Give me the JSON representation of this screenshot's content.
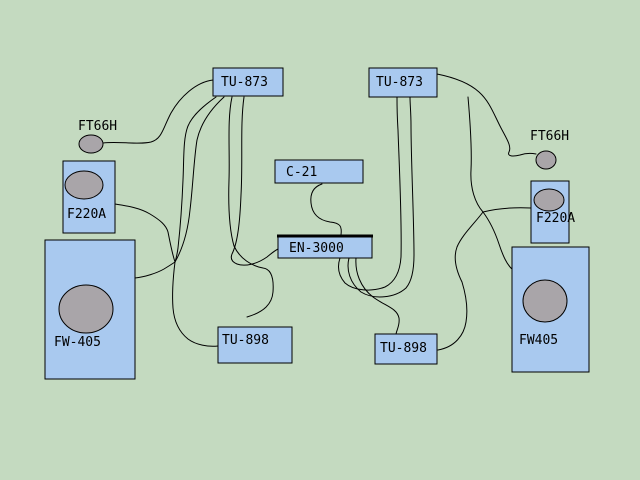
{
  "diagram": {
    "title": "stereo-system-wiring-diagram",
    "colors": {
      "background": "#c4dac0",
      "component_box_fill": "#a9c9ef",
      "driver_fill": "#a9a5a9",
      "line": "#000000"
    },
    "components": {
      "tu873_left": {
        "label": "TU-873"
      },
      "tu873_right": {
        "label": "TU-873"
      },
      "c21": {
        "label": "C-21"
      },
      "en3000": {
        "label": "EN-3000"
      },
      "tu898_left": {
        "label": "TU-898"
      },
      "tu898_right": {
        "label": "TU-898"
      },
      "f220a_left": {
        "label": "F220A"
      },
      "f220a_right": {
        "label": "F220A"
      },
      "ft66h_left": {
        "label": "FT66H"
      },
      "ft66h_right": {
        "label": "FT66H"
      },
      "fw405_left": {
        "label": "FW-405"
      },
      "fw405_right": {
        "label": "FW405"
      }
    }
  }
}
